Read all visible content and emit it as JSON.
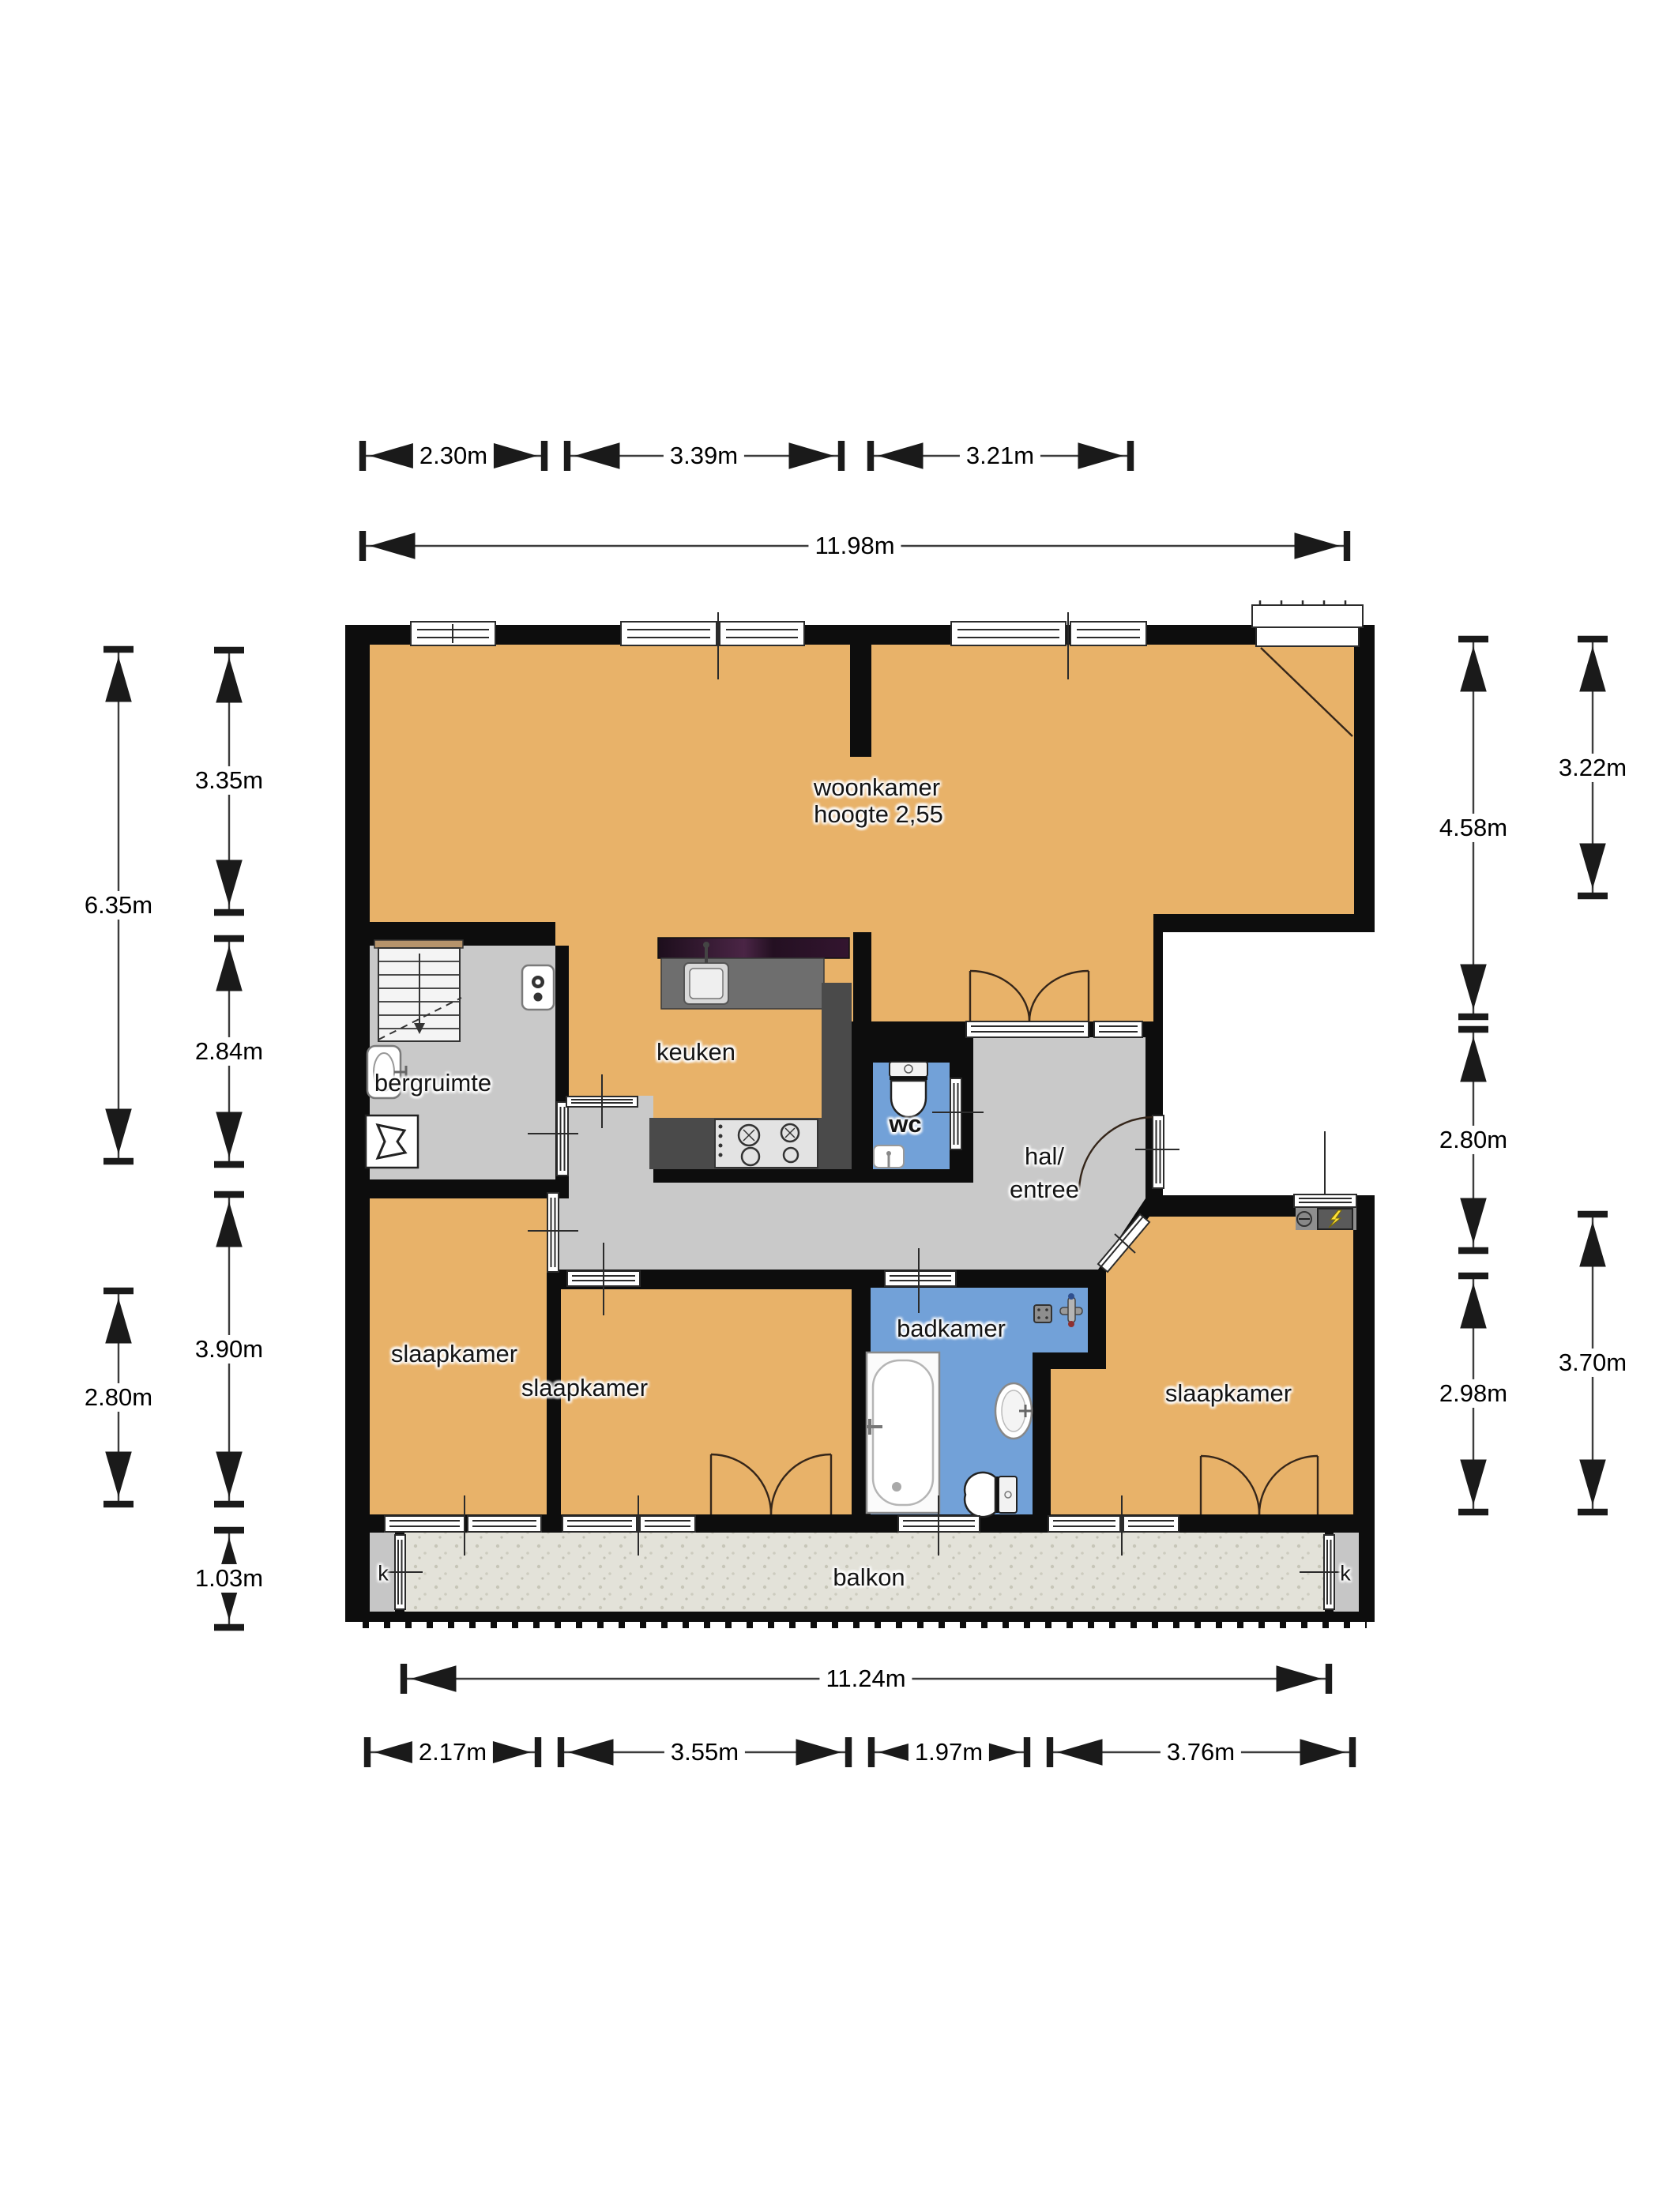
{
  "plan_type": "floorplan",
  "rooms": {
    "woonkamer": {
      "name": "woonkamer",
      "height_note": "hoogte 2,55"
    },
    "keuken": {
      "name": "keuken"
    },
    "bergruimte": {
      "name": "bergruimte"
    },
    "wc": {
      "name": "wc"
    },
    "hal": {
      "line1": "hal/",
      "line2": "entree"
    },
    "badkamer": {
      "name": "badkamer"
    },
    "slaapkamer_left": {
      "name": "slaapkamer"
    },
    "slaapkamer_middle": {
      "name": "slaapkamer"
    },
    "slaapkamer_right": {
      "name": "slaapkamer"
    },
    "balkon": {
      "name": "balkon"
    },
    "kast_left": {
      "name": "k"
    },
    "kast_right": {
      "name": "k"
    }
  },
  "dimensions": {
    "top": {
      "segments": [
        "2.30m",
        "3.39m",
        "3.21m"
      ],
      "total": "11.98m"
    },
    "bottom": {
      "total": "11.24m",
      "segments": [
        "2.17m",
        "3.55m",
        "1.97m",
        "3.76m"
      ]
    },
    "left": {
      "outer": [
        "6.35m",
        "2.80m"
      ],
      "inner": [
        "3.35m",
        "2.84m",
        "3.90m",
        "1.03m"
      ]
    },
    "right": {
      "inner": [
        "4.58m",
        "2.80m",
        "2.98m"
      ],
      "outer": [
        "3.22m",
        "3.70m"
      ]
    }
  },
  "colors": {
    "wall": "#0d0d0d",
    "floor_living": "#e8b269",
    "floor_hall": "#c9c9c9",
    "floor_bath": "#72a1d8",
    "floor_balcony": "#e3e2d9",
    "counter_dark": "#4a4a4a",
    "counter_top_purple": "#2b1428",
    "meter_accent": "#ffe23a"
  }
}
